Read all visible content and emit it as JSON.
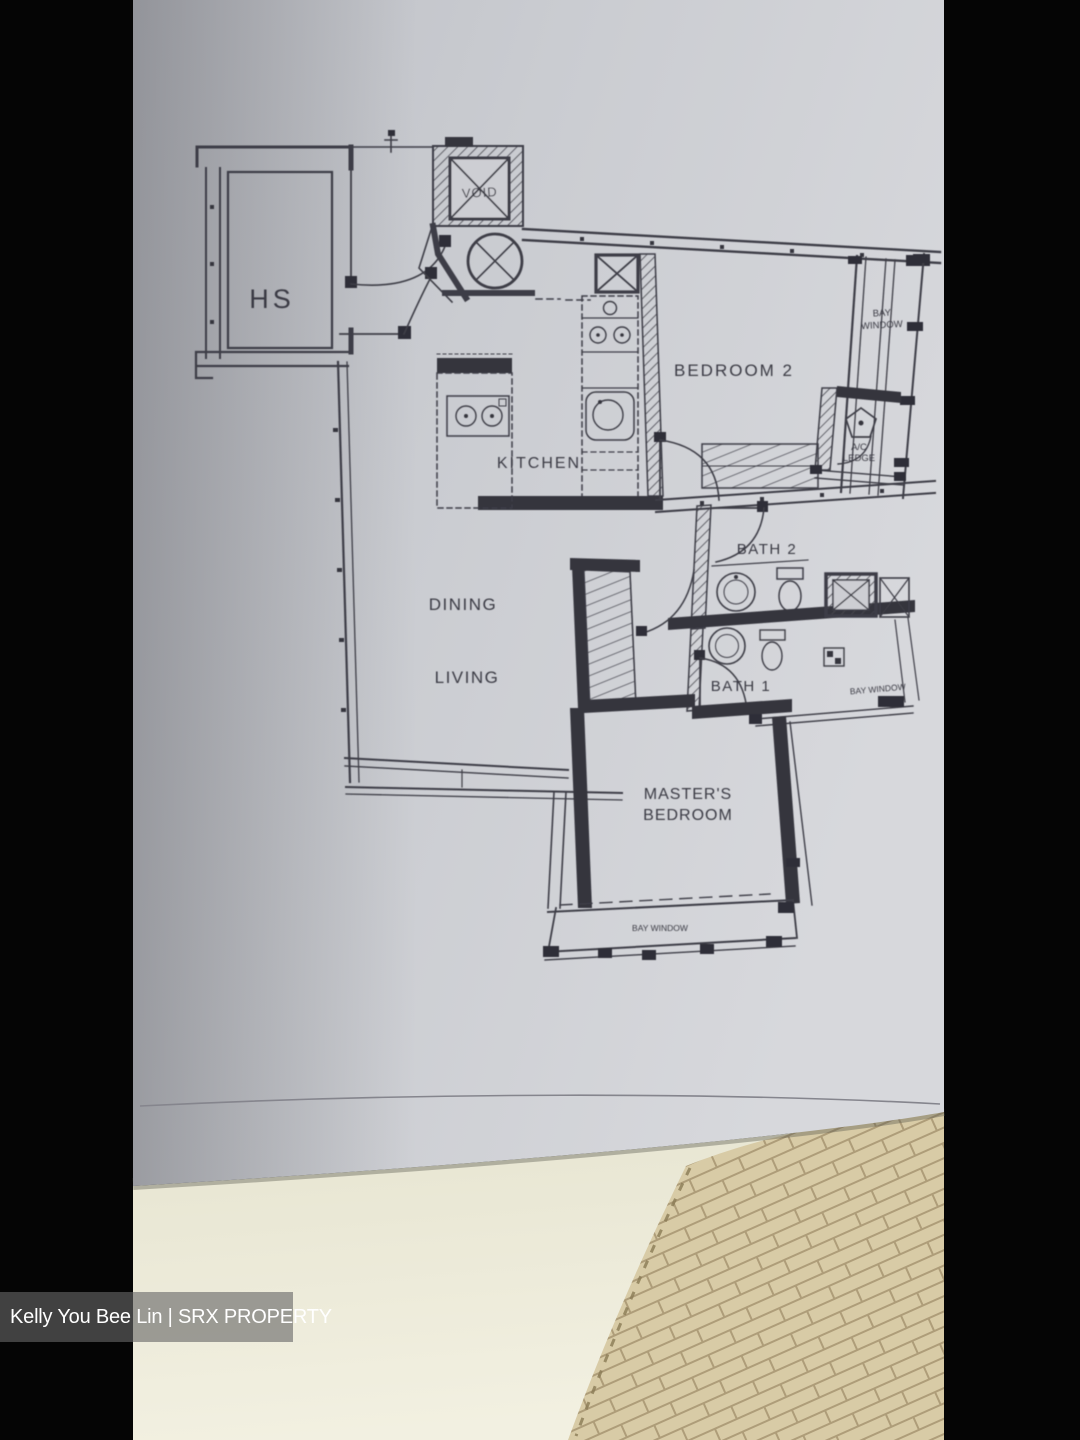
{
  "photo": {
    "watermark": "Kelly You Bee Lin | SRX PROPERTY"
  },
  "floor_plan": {
    "rooms": {
      "hs": "HS",
      "void": "VOID",
      "kitchen": "KITCHEN",
      "bedroom2": "BEDROOM 2",
      "dining": "DINING",
      "living": "LIVING",
      "bath2": "BATH 2",
      "bath1": "BATH 1",
      "master_line1": "MASTER'S",
      "master_line2": "BEDROOM"
    },
    "annotations": {
      "bay_window_line1": "BAY",
      "bay_window_line2": "WINDOW",
      "ac_ledge_line1": "A/C",
      "ac_ledge_line2": "LEDGE",
      "bay_window_bath": "BAY WINDOW",
      "bay_window_master": "BAY WINDOW"
    }
  },
  "colors": {
    "background": "#050505",
    "paper": "#cbccd1",
    "ink": "#3e3e46",
    "wall_fill": "#34343c",
    "floor": "#ebe8d6",
    "tile": "#d8cba6",
    "tile_seam": "#ae9d79",
    "watermark_bar": "rgba(104,104,104,0.62)",
    "watermark_text": "#ffffff"
  }
}
